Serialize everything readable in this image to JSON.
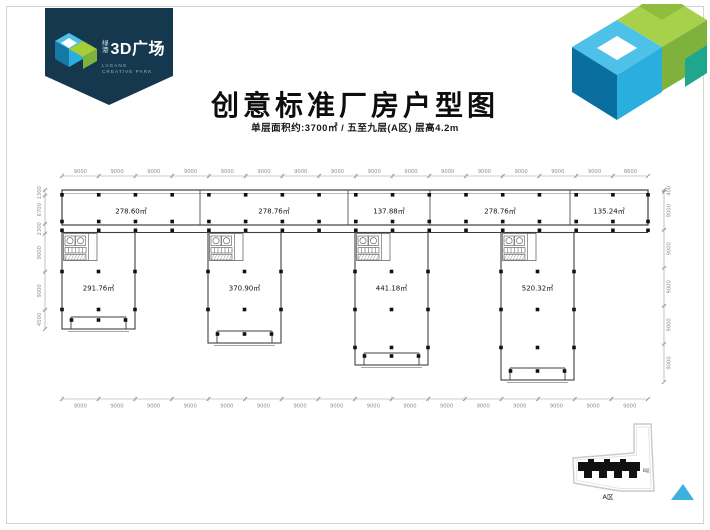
{
  "header": {
    "title": "创意标准厂房户型图",
    "subtitle": "单层面积约:3700㎡ / 五至九层(A区) 层高4.2m"
  },
  "logo": {
    "cn_small": "绿\n港",
    "cn_large": "3D广场",
    "en_line1": "LVGANG",
    "en_line2": "CREATIVE PARK"
  },
  "floorplan": {
    "dims": {
      "top": [
        "9000",
        "9000",
        "9000",
        "9000",
        "9000",
        "9000",
        "9000",
        "9000",
        "9000",
        "9000",
        "9000",
        "9000",
        "9000",
        "9000",
        "9000",
        "8600"
      ],
      "bottom": [
        "9000",
        "9000",
        "9000",
        "9000",
        "9000",
        "9000",
        "9000",
        "9000",
        "9000",
        "9000",
        "9000",
        "9000",
        "9000",
        "9000",
        "9000",
        "9000"
      ],
      "left": [
        "1300",
        "6700",
        "2300",
        "9000",
        "9000",
        "4500"
      ],
      "right": [
        "400",
        "9000",
        "9000",
        "9000",
        "9000",
        "9000"
      ]
    },
    "upper_units": [
      {
        "area": "278.60㎡"
      },
      {
        "area": "278.76㎡"
      },
      {
        "area": "137.88㎡"
      },
      {
        "area": "278.76㎡"
      },
      {
        "area": "135.24㎡"
      }
    ],
    "lower_units": [
      {
        "area": "291.76㎡"
      },
      {
        "area": "370.90㎡"
      },
      {
        "area": "441.18㎡"
      },
      {
        "area": "520.32㎡"
      }
    ]
  },
  "keyplan": {
    "zone_a": "A区",
    "zone_b": "B区"
  },
  "colors": {
    "banner_navy": "#16384f",
    "blue_dark": "#0a6f9f",
    "blue_mid": "#2aaedd",
    "blue_light": "#4ec1e9",
    "green_light": "#a8d14b",
    "green_dark": "#7eb23c",
    "teal": "#1fa78e",
    "plan_line": "#3f3f3f",
    "dim_text": "#8f8f8f"
  }
}
